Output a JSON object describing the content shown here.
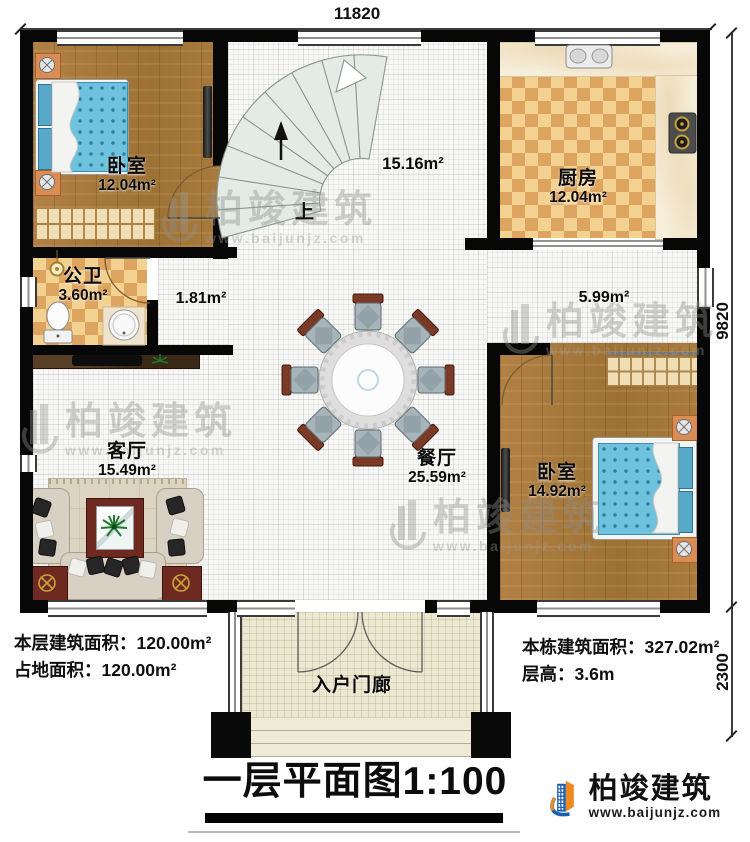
{
  "dims": {
    "top": "11820",
    "right_upper": "9820",
    "right_lower": "2300"
  },
  "rooms": {
    "bedroom1": {
      "name": "卧室",
      "area": "12.04m²"
    },
    "hall": {
      "area": "15.16m²"
    },
    "kitchen": {
      "name": "厨房",
      "area": "12.04m²"
    },
    "bathroom": {
      "name": "公卫",
      "area": "3.60m²"
    },
    "corridor_a": {
      "area": "1.81m²"
    },
    "corridor_b": {
      "area": "5.99m²"
    },
    "living": {
      "name": "客厅",
      "area": "15.49m²"
    },
    "dining": {
      "name": "餐厅",
      "area": "25.59m²"
    },
    "bedroom2": {
      "name": "卧室",
      "area": "14.92m²"
    },
    "porch": {
      "name": "入户门廊"
    }
  },
  "stairs": {
    "up_label": "上"
  },
  "stats": {
    "floor_area": {
      "label": "本层建筑面积：",
      "value": "120.00m²"
    },
    "footprint": {
      "label": "占地面积：",
      "value": "120.00m²"
    },
    "building_total": {
      "label": "本栋建筑面积：",
      "value": "327.02m²"
    },
    "storey_height": {
      "label": "层高：",
      "value": "3.6m"
    }
  },
  "title": {
    "text": "一层平面图",
    "scale": "1:100"
  },
  "brand": {
    "name": "柏竣建筑",
    "website": "www.baijunjz.com"
  },
  "colors": {
    "wall": "#070707",
    "wood": "#a87a3c",
    "checker_light": "#f3d191",
    "checker_dark": "#dda45f",
    "bed_blue": "#6fc2de",
    "brand_blue": "#1a5fb0",
    "brand_orange": "#f08a1e"
  }
}
